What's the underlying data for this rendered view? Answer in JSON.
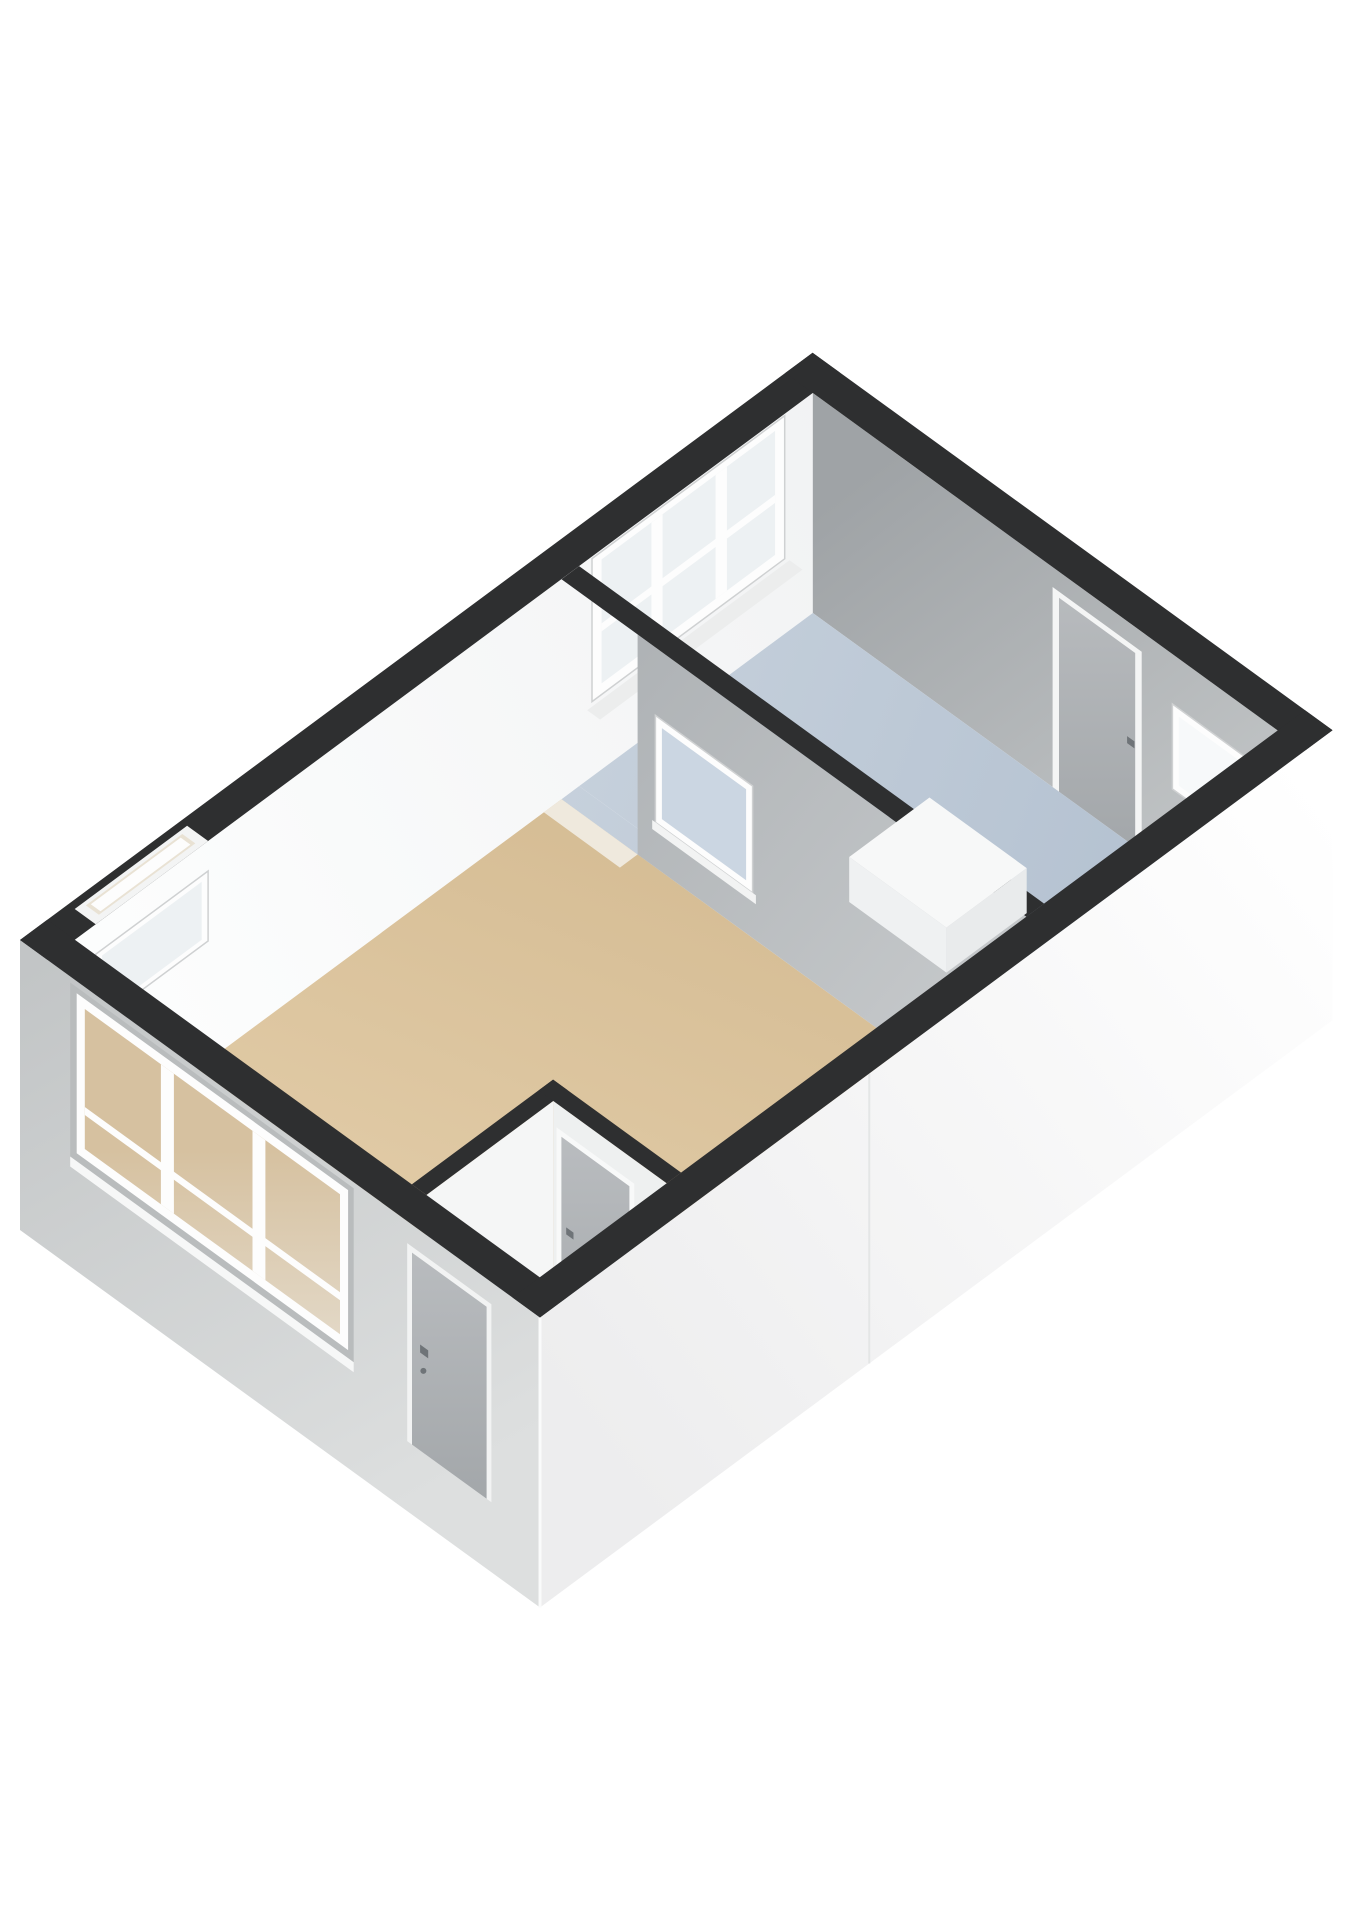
{
  "scene": {
    "background": "#ffffff",
    "projection": {
      "origin": [
        20,
        940
      ],
      "u": [
        0.803,
        -0.595
      ],
      "v": [
        0.81,
        0.588
      ],
      "wall_height": 220,
      "base_depth": 70
    },
    "building": {
      "length_u": 987,
      "width_v": 642,
      "ext_wall_thickness": 34,
      "int_wall_thickness": 22
    },
    "colors": {
      "cap": "#2e2f30",
      "inner_white_wall": "#fafbfb",
      "inner_gray_top": "#9fa3a6",
      "inner_gray_bottom": "#c9cccd",
      "partition_top": "#acb0b3",
      "partition_bottom": "#c7cacc",
      "floor_tan_light": "#e6d1ae",
      "floor_tan_dark": "#d0b68c",
      "floor_blue_light": "#c8d2dd",
      "floor_blue_dark": "#b1bfcf",
      "ext_left_top": "#c2c5c6",
      "ext_left_bottom": "#dddfdf",
      "ext_right_left": "#ededee",
      "ext_right_right": "#ffffff",
      "frame_white": "#fdfdfd",
      "frame_shadow": "#cfd1d2",
      "reveal_shadow": "#b9bcbd",
      "glass_cool": "#edf1f3",
      "glass_blue": "#cbd6e2",
      "glass_bright": "#f7f9fa",
      "glass_tan_top": "#d6c1a0",
      "glass_tan_bottom": "#ebe8e1",
      "door_light": "#b9bcbf",
      "door_dark": "#a2a6a9",
      "handle": "#6f7478",
      "hall_wall_a": "#f5f6f6",
      "hall_wall_b": "#eef0f0",
      "threshold": "#efe9dd",
      "sill": "#f6f7f7",
      "box_top": "#f7f8f8",
      "box_side_v": "#e9ebec",
      "box_side_u": "#eff1f2",
      "cap_notch": "#f3f4f4",
      "cap_notch_slot": "#e9e2d4",
      "seam": "#e4e6e6",
      "corner_highlight": "#fafbfb"
    },
    "rooms": [
      {
        "id": "living-room",
        "floor": "tan",
        "shape": [
          [
            34,
            34
          ],
          [
            640,
            34
          ],
          [
            640,
            608
          ],
          [
            210,
            608
          ],
          [
            210,
            450
          ],
          [
            34,
            450
          ]
        ]
      },
      {
        "id": "bedroom",
        "floor": "blue",
        "shape": [
          [
            662,
            34
          ],
          [
            953,
            34
          ],
          [
            953,
            608
          ],
          [
            662,
            608
          ]
        ]
      },
      {
        "id": "hallway",
        "floor": "tan",
        "shape": [
          [
            34,
            468
          ],
          [
            192,
            468
          ],
          [
            192,
            608
          ],
          [
            34,
            608
          ]
        ]
      },
      {
        "id": "doorway-strip",
        "floor": "blue",
        "shape": [
          [
            640,
            34
          ],
          [
            662,
            34
          ],
          [
            662,
            128
          ],
          [
            640,
            128
          ]
        ]
      }
    ],
    "walls": {
      "top_left": {
        "slit_window": {
          "u": [
            60,
            200
          ],
          "z": [
            120,
            190
          ]
        },
        "bedroom_window": {
          "u": [
            678,
            918
          ],
          "z": [
            75,
            218
          ],
          "glass": [
            690,
            86,
            906,
            210
          ],
          "mullions": [
            [
              752,
              766
            ],
            [
              832,
              846
            ]
          ],
          "rail_z": [
            138,
            146
          ]
        }
      },
      "top_right": {
        "door": {
          "v": [
            330,
            440
          ],
          "z": [
            0,
            200
          ],
          "leaf": [
            338,
            432,
            194
          ],
          "handle_v": 422,
          "handle_z": 98
        },
        "window": {
          "v": [
            478,
            575
          ],
          "z": [
            85,
            170
          ],
          "glass": [
            486,
            93,
            567,
            162
          ]
        }
      },
      "front_left": {
        "window": {
          "v": [
            70,
            405
          ],
          "z": [
            48,
            208
          ],
          "recess": [
            62,
            40,
            412,
            214
          ],
          "glass": [
            80,
            58,
            395,
            198
          ],
          "mullions": [
            [
              174,
              190
            ],
            [
              287,
              303
            ]
          ],
          "rail_z": [
            92,
            100
          ]
        },
        "door": {
          "v": [
            478,
            582
          ],
          "z": [
            0,
            198
          ],
          "leaf": [
            484,
            576,
            192
          ],
          "handle_v": 494,
          "handle_z": 98
        }
      },
      "bottom_right": {
        "seam_u": 410
      },
      "partition": {
        "u": [
          640,
          662
        ],
        "solid_v": [
          128,
          608
        ],
        "opening_v": [
          34,
          128
        ],
        "window": {
          "v": [
            150,
            270
          ],
          "z": [
            45,
            152
          ],
          "glass": [
            158,
            53,
            262,
            144
          ]
        }
      },
      "hall_wall_a": {
        "v": [
          450,
          468
        ],
        "u": [
          34,
          210
        ]
      },
      "hall_wall_b": {
        "u": [
          192,
          210
        ],
        "v": [
          450,
          608
        ],
        "door": {
          "v": [
            472,
            568
          ],
          "z": [
            0,
            196
          ],
          "leaf": [
            478,
            562,
            190
          ],
          "handle_v": 484,
          "handle_z": 96
        }
      }
    },
    "furniture": [
      {
        "id": "white-box",
        "u": [
          730,
          830
        ],
        "v": [
          300,
          420
        ],
        "height": 45
      }
    ]
  }
}
